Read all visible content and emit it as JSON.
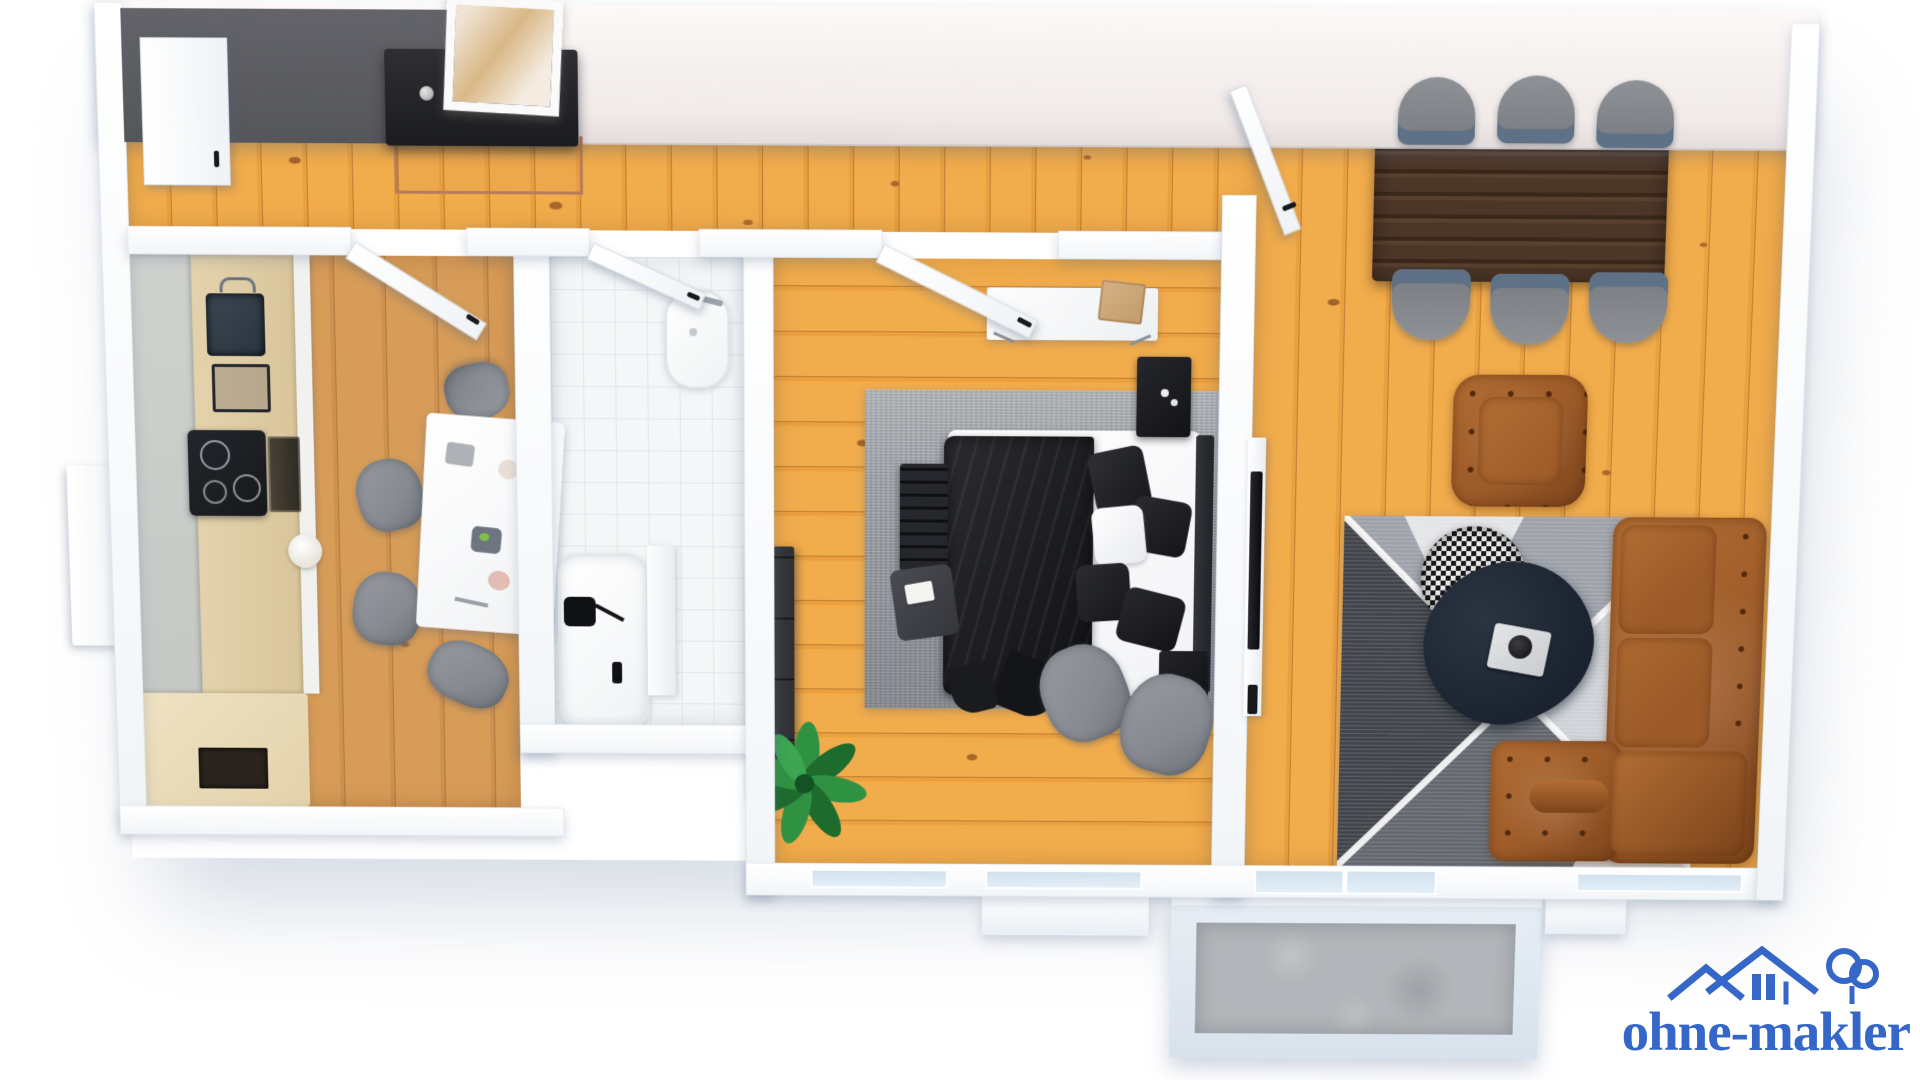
{
  "scene": {
    "type": "3d-floor-plan-render",
    "view": "top-down",
    "background": "#FFFFFF",
    "watermark_position": "bottom-right"
  },
  "brand": {
    "logo_text": "ohne-makler",
    "logo_color": "#3467C8",
    "logo_icon": "houses-and-tree-icon"
  },
  "palette": {
    "bg": "#FFFFFF",
    "wallTop": "#F2F5F8",
    "wallFace": "#F0EAE8",
    "wallDark": "#55565A",
    "pine": "#F1AC4C",
    "pineStreak": "#EBA03E",
    "oak": "#D79C58",
    "oakStreak": "#CE9150",
    "tile": "#F4F6F7",
    "tileLine": "#E3E7EA",
    "concrete": "#B2B5B9",
    "balconyWall": "#E7EEF5",
    "glass": "#CFE0ED",
    "counterStone": "#C6C8C5",
    "counterWood": "#E3D2AC",
    "cabinetWhite": "#F1F1EF",
    "cooktop": "#16181C",
    "sinkDark": "#2A3440",
    "copper": "#B97C5B",
    "consoleBlack": "#1B1C20",
    "artGold": "#D9B886",
    "rugGray": "#9B9EA4",
    "rugGrayDark": "#7F838A",
    "bedding": "#1C1D21",
    "mattress": "#F2F3F5",
    "pillowWhite": "#E8EAEE",
    "chairGray": "#878B91",
    "plantGreen": "#2F9242",
    "plantDark": "#1E6B2E",
    "walnut": "#4C3628",
    "walnutDark": "#3A2719",
    "shellChair": "#787C80",
    "chairSeat": "#5E7186",
    "leather": "#9C5A28",
    "leatherHi": "#B26D33",
    "leatherLo": "#7C441B",
    "rugTriTop": "#9EA2AA",
    "rugTriRight": "#CFD3D8",
    "rugTriBottom": "#64686F",
    "rugTriLeft": "#42454B",
    "rugTriBase": "#F0F1F3",
    "pouf1": "#17181B",
    "pouf2": "#ECECEA",
    "coffee": "#1B2330",
    "tray": "#C9CBCD",
    "handle": "#17181B",
    "logoBlue": "#3467C8"
  },
  "rooms": [
    {
      "id": "entry-hall",
      "floor": "pine-planks",
      "items": [
        "entry-door",
        "dark-feature-wall",
        "console-table",
        "copper-frame",
        "framed-artwork",
        "decor-knobs"
      ]
    },
    {
      "id": "kitchen",
      "floor": "oak-planks",
      "items": [
        "stone-worktop",
        "wood-counter",
        "sink",
        "faucet",
        "spice-rack",
        "induction-cooktop",
        "built-in-oven",
        "kettle",
        "lower-cabinet",
        "shelf-niche",
        "side-cabinet",
        "dining-table-set",
        "dining-chair-x4",
        "kitchen-door"
      ]
    },
    {
      "id": "bathroom",
      "floor": "white-tiles",
      "items": [
        "washbasin",
        "bathtub",
        "shower-fixture",
        "bath-cabinet",
        "bathroom-door"
      ]
    },
    {
      "id": "bedroom",
      "floor": "pine-planks",
      "items": [
        "gray-area-rug",
        "double-bed-black-bedding",
        "pillows",
        "headboard",
        "foot-bench",
        "dark-throw",
        "book",
        "nightstand-x2",
        "desk-hairpin-legs",
        "cardboard-box",
        "dresser",
        "palm-plant",
        "lounge-chair-x2",
        "window-x2",
        "bedroom-door"
      ]
    },
    {
      "id": "living-room",
      "floor": "pine-planks",
      "items": [
        "walnut-dining-table",
        "shell-chair-x6",
        "tufted-leather-armchair",
        "corner-sofa-leather",
        "geometric-rug",
        "houndstooth-pouf",
        "coffee-table",
        "serving-tray",
        "tv-lowboard",
        "tv",
        "living-room-door",
        "balcony-glass-door",
        "window"
      ]
    },
    {
      "id": "balcony",
      "floor": "concrete",
      "items": [
        "parapet-walls"
      ]
    }
  ]
}
